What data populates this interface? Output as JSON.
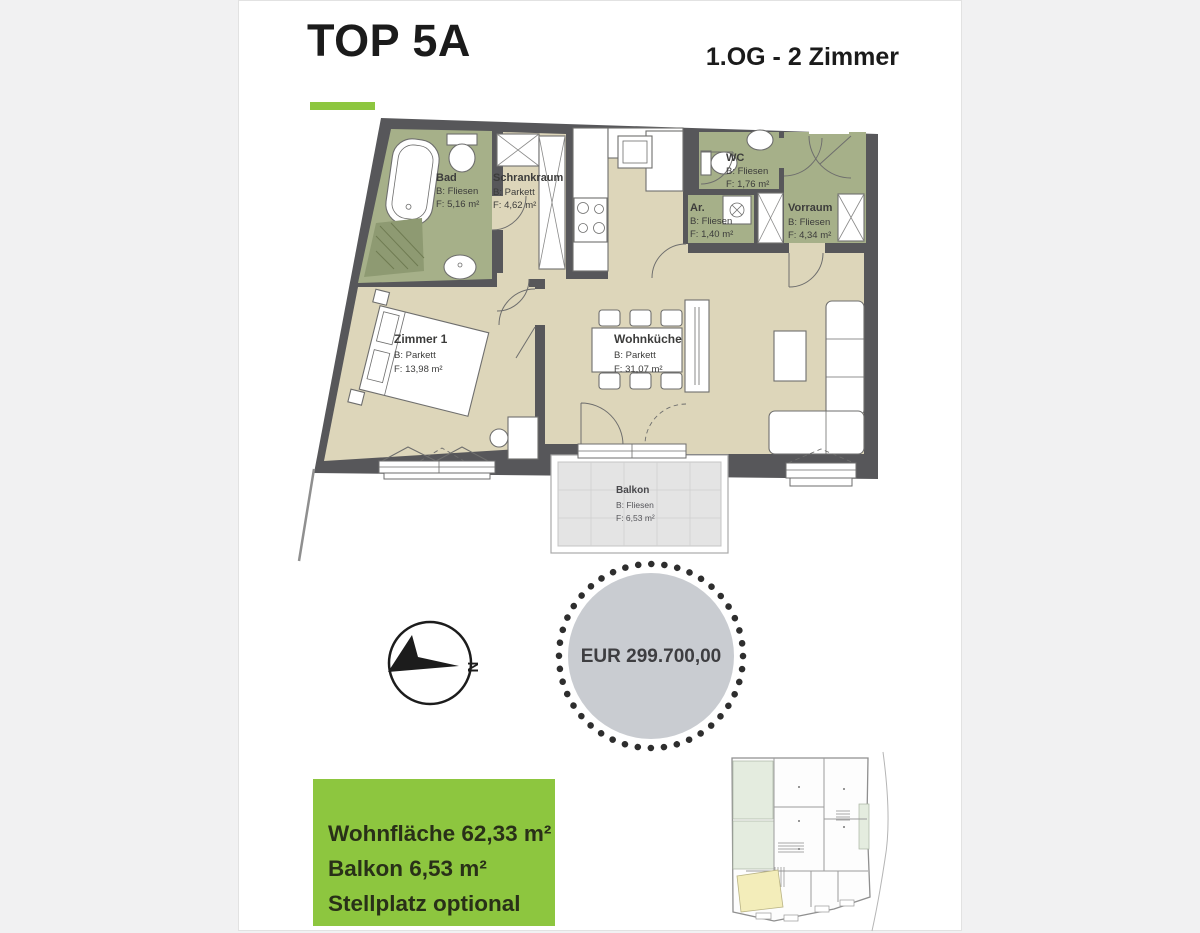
{
  "header": {
    "title": "TOP 5A",
    "subtitle": "1.OG - 2 Zimmer"
  },
  "colors": {
    "accent_green": "#8dc63f",
    "wall_gray": "#57575a",
    "floor_beige": "#ddd6ba",
    "wet_room_green": "#a6b089",
    "balcony_gray": "#e4e4e4",
    "price_circle_gray": "#c9ccd1",
    "siteplan_highlight_yellow": "#f3edba"
  },
  "floorplan": {
    "rooms": [
      {
        "name": "Bad",
        "floor": "B: Fliesen",
        "area": "F: 5,16 m²"
      },
      {
        "name": "Schrankraum",
        "floor": "B: Parkett",
        "area": "F: 4,62 m²"
      },
      {
        "name": "WC",
        "floor": "B: Fliesen",
        "area": "F: 1,76 m²"
      },
      {
        "name": "Ar.",
        "floor": "B: Fliesen",
        "area": "F: 1,40 m²"
      },
      {
        "name": "Vorraum",
        "floor": "B: Fliesen",
        "area": "F: 4,34 m²"
      },
      {
        "name": "Zimmer 1",
        "floor": "B: Parkett",
        "area": "F: 13,98 m²"
      },
      {
        "name": "Wohnküche",
        "floor": "B: Parkett",
        "area": "F: 31,07 m²"
      },
      {
        "name": "Balkon",
        "floor": "B: Fliesen",
        "area": "F: 6,53 m²"
      }
    ],
    "compass_label": "N"
  },
  "price_badge": {
    "label": "EUR 299.700,00"
  },
  "summary_box": {
    "lines": [
      "Wohnfläche 62,33 m²",
      "Balkon 6,53 m²",
      "Stellplatz optional"
    ]
  }
}
